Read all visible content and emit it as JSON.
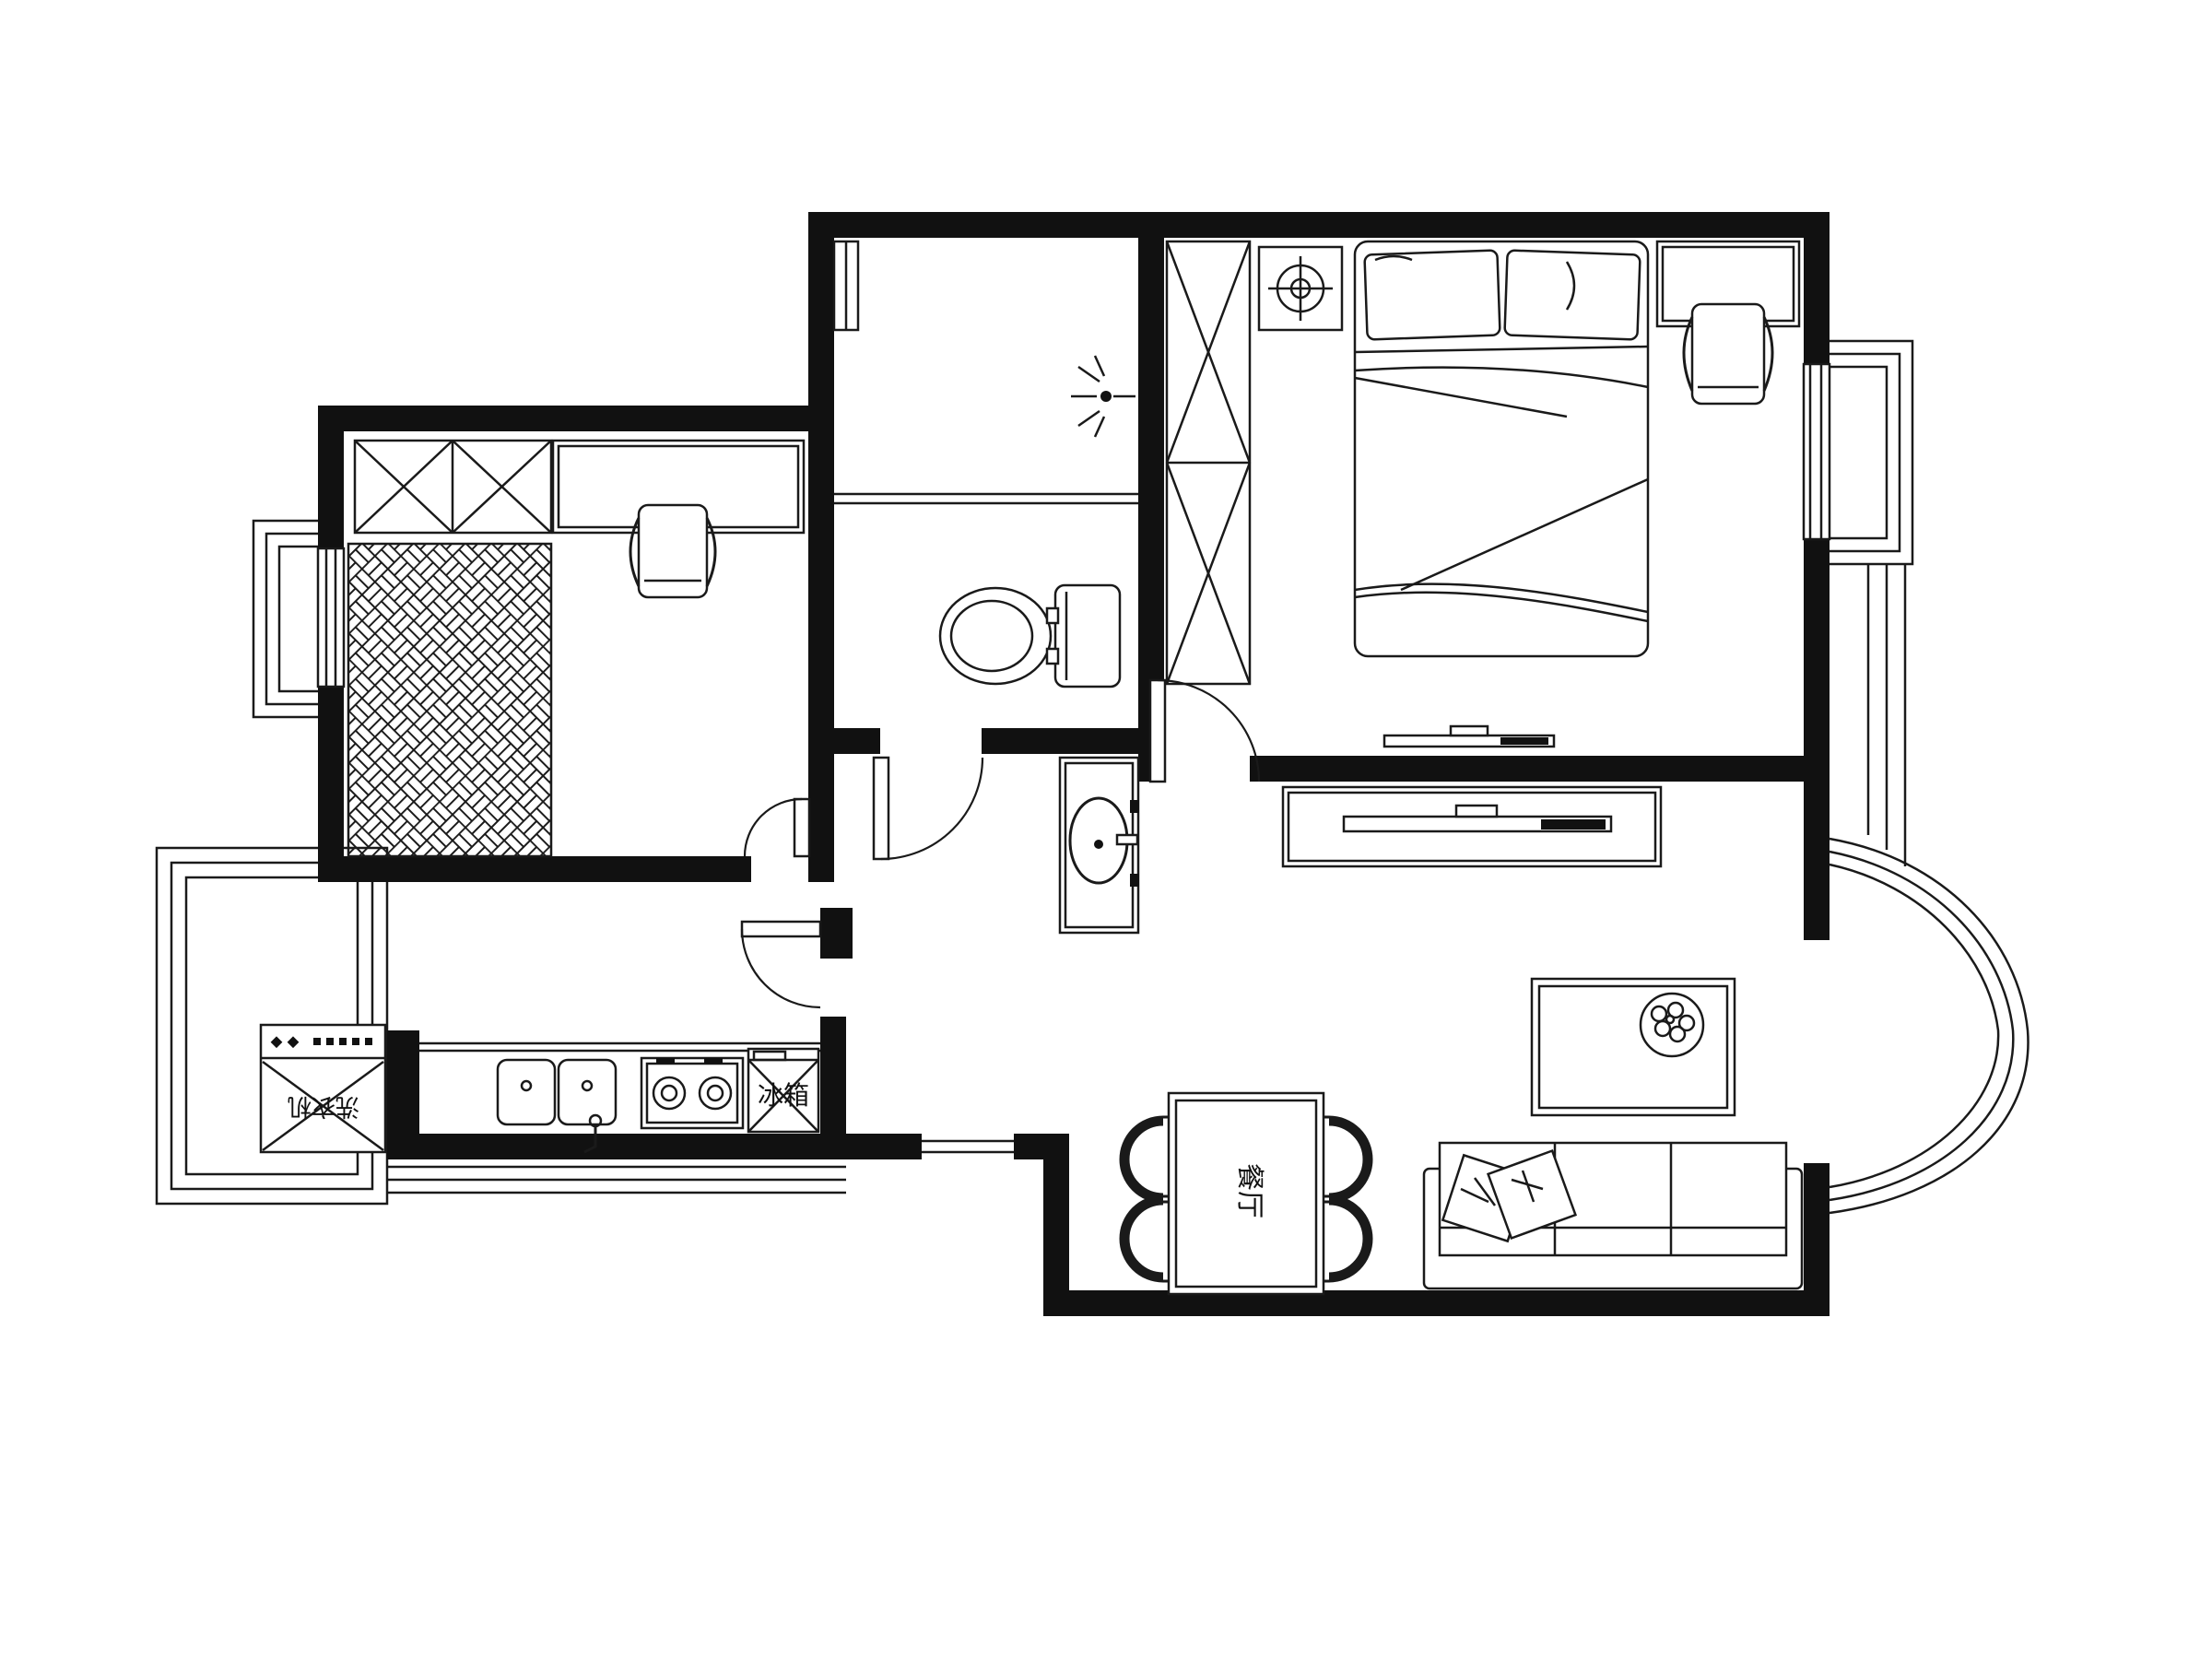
{
  "labels": {
    "dining_room": "餐厅",
    "refrigerator": "冰箱",
    "washing_machine": "洗衣机"
  },
  "colors": {
    "background": "#ffffff",
    "walls": "#111111",
    "lines": "#1a1a1a"
  }
}
